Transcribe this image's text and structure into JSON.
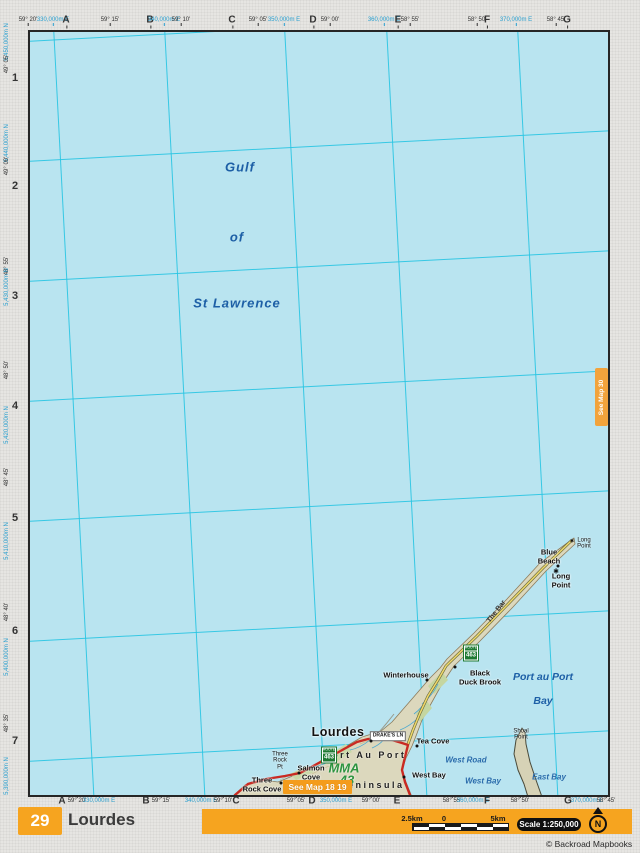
{
  "page": {
    "number": "29",
    "title": "Lourdes",
    "scale_label": "Scale 1:250,000",
    "copyright": "© Backroad Mapbooks",
    "north_label": "N",
    "see_map_right": "See Map 30",
    "see_map_bottom": "See Map 18 19",
    "scale_bar": {
      "left": "2.5km",
      "zero": "0",
      "right": "5km"
    }
  },
  "colors": {
    "accent_orange": "#f6a41f",
    "water": "#b9e4f0",
    "grid_cyan": "#28c4e2",
    "land": "#dcd8bd",
    "road_red": "#c92a22",
    "road_yellow": "#efd96b",
    "shield_green": "#1f7a33",
    "water_label_blue": "#1d5fa6",
    "utm_label_blue": "#2aa0d0",
    "mma_green": "#2e9440"
  },
  "margins": {
    "top": [
      {
        "t": "59° 20'",
        "x": 28,
        "cls": "deg"
      },
      {
        "t": "330,000m E",
        "x": 53,
        "cls": "utm"
      },
      {
        "t": "A",
        "x": 66,
        "cls": "col"
      },
      {
        "t": "59° 15'",
        "x": 110,
        "cls": "deg"
      },
      {
        "t": "B",
        "x": 150,
        "cls": "col"
      },
      {
        "t": "340,000m E",
        "x": 164,
        "cls": "utm"
      },
      {
        "t": "59° 10'",
        "x": 181,
        "cls": "deg"
      },
      {
        "t": "C",
        "x": 232,
        "cls": "col"
      },
      {
        "t": "59° 05'",
        "x": 258,
        "cls": "deg"
      },
      {
        "t": "350,000m E",
        "x": 284,
        "cls": "utm"
      },
      {
        "t": "D",
        "x": 313,
        "cls": "col"
      },
      {
        "t": "59° 00'",
        "x": 330,
        "cls": "deg"
      },
      {
        "t": "360,000m E",
        "x": 384,
        "cls": "utm"
      },
      {
        "t": "E",
        "x": 398,
        "cls": "col"
      },
      {
        "t": "58° 55'",
        "x": 410,
        "cls": "deg"
      },
      {
        "t": "58° 50'",
        "x": 477,
        "cls": "deg"
      },
      {
        "t": "F",
        "x": 487,
        "cls": "col"
      },
      {
        "t": "370,000m E",
        "x": 516,
        "cls": "utm"
      },
      {
        "t": "58° 45'",
        "x": 556,
        "cls": "deg"
      },
      {
        "t": "G",
        "x": 567,
        "cls": "col"
      }
    ],
    "bottom": [
      {
        "t": "A",
        "x": 62,
        "cls": "col"
      },
      {
        "t": "59° 20'",
        "x": 77,
        "cls": "deg"
      },
      {
        "t": "330,000m E",
        "x": 99,
        "cls": "utm"
      },
      {
        "t": "B",
        "x": 146,
        "cls": "col"
      },
      {
        "t": "59° 15'",
        "x": 161,
        "cls": "deg"
      },
      {
        "t": "340,000m E",
        "x": 201,
        "cls": "utm"
      },
      {
        "t": "59° 10'",
        "x": 223,
        "cls": "deg"
      },
      {
        "t": "C",
        "x": 236,
        "cls": "col"
      },
      {
        "t": "59° 05'",
        "x": 296,
        "cls": "deg"
      },
      {
        "t": "D",
        "x": 312,
        "cls": "col"
      },
      {
        "t": "350,000m E",
        "x": 336,
        "cls": "utm"
      },
      {
        "t": "59° 00'",
        "x": 371,
        "cls": "deg"
      },
      {
        "t": "E",
        "x": 397,
        "cls": "col"
      },
      {
        "t": "58° 55'",
        "x": 452,
        "cls": "deg"
      },
      {
        "t": "360,000m E",
        "x": 473,
        "cls": "utm"
      },
      {
        "t": "F",
        "x": 487,
        "cls": "col"
      },
      {
        "t": "58° 50'",
        "x": 520,
        "cls": "deg"
      },
      {
        "t": "G",
        "x": 568,
        "cls": "col"
      },
      {
        "t": "370,000m E",
        "x": 587,
        "cls": "utm"
      },
      {
        "t": "58° 45'",
        "x": 606,
        "cls": "deg"
      }
    ],
    "left": [
      {
        "t": "5,450,000m N",
        "x": 7,
        "y": 42,
        "cls": "utm"
      },
      {
        "t": "49° 05'",
        "x": 7,
        "y": 64,
        "cls": "deg"
      },
      {
        "t": "1",
        "x": 15,
        "y": 78,
        "cls": "row"
      },
      {
        "t": "5,440,000m N",
        "x": 7,
        "y": 143,
        "cls": "utm"
      },
      {
        "t": "49° 00'",
        "x": 7,
        "y": 166,
        "cls": "deg"
      },
      {
        "t": "2",
        "x": 15,
        "y": 186,
        "cls": "row"
      },
      {
        "t": "48° 55'",
        "x": 7,
        "y": 266,
        "cls": "deg"
      },
      {
        "t": "5,430,000m N",
        "x": 7,
        "y": 287,
        "cls": "utm"
      },
      {
        "t": "3",
        "x": 15,
        "y": 296,
        "cls": "row"
      },
      {
        "t": "48° 50'",
        "x": 7,
        "y": 370,
        "cls": "deg"
      },
      {
        "t": "4",
        "x": 15,
        "y": 406,
        "cls": "row"
      },
      {
        "t": "5,420,000m N",
        "x": 7,
        "y": 425,
        "cls": "utm"
      },
      {
        "t": "48° 45'",
        "x": 7,
        "y": 477,
        "cls": "deg"
      },
      {
        "t": "5",
        "x": 15,
        "y": 518,
        "cls": "row"
      },
      {
        "t": "5,410,000m N",
        "x": 7,
        "y": 541,
        "cls": "utm"
      },
      {
        "t": "48° 40'",
        "x": 7,
        "y": 612,
        "cls": "deg"
      },
      {
        "t": "6",
        "x": 15,
        "y": 631,
        "cls": "row"
      },
      {
        "t": "5,400,000m N",
        "x": 7,
        "y": 657,
        "cls": "utm"
      },
      {
        "t": "48° 35'",
        "x": 7,
        "y": 723,
        "cls": "deg"
      },
      {
        "t": "7",
        "x": 15,
        "y": 741,
        "cls": "row"
      },
      {
        "t": "5,390,000m N",
        "x": 7,
        "y": 776,
        "cls": "utm"
      }
    ]
  },
  "map": {
    "labels": [
      {
        "t": "Gulf",
        "x": 210,
        "y": 136,
        "cls": "water-big"
      },
      {
        "t": "of",
        "x": 207,
        "y": 206,
        "cls": "water-big"
      },
      {
        "t": "St Lawrence",
        "x": 207,
        "y": 272,
        "cls": "water-big"
      },
      {
        "t": "Port au Port",
        "x": 513,
        "y": 645,
        "cls": "water-mid"
      },
      {
        "t": "Bay",
        "x": 513,
        "y": 669,
        "cls": "water-mid"
      },
      {
        "t": "The Bar",
        "x": 467,
        "y": 580,
        "cls": "road-name",
        "rot": -52
      },
      {
        "t": "Blue\nBeach",
        "x": 519,
        "y": 525,
        "cls": "town"
      },
      {
        "t": "Long\nPoint",
        "x": 531,
        "y": 549,
        "cls": "town"
      },
      {
        "t": "Long\nPoint",
        "x": 554,
        "y": 512,
        "cls": "tiny"
      },
      {
        "t": "Winterhouse",
        "x": 376,
        "y": 644,
        "cls": "town"
      },
      {
        "t": "Black\nDuck Brook",
        "x": 450,
        "y": 646,
        "cls": "town"
      },
      {
        "t": "Lourdes",
        "x": 308,
        "y": 700,
        "cls": "town-big"
      },
      {
        "t": "DRAKE'S LN",
        "x": 358,
        "y": 704,
        "cls": "street-box"
      },
      {
        "t": "Tea Cove",
        "x": 403,
        "y": 710,
        "cls": "town"
      },
      {
        "t": "Port Au Port",
        "x": 335,
        "y": 723,
        "cls": "area"
      },
      {
        "t": "MMA",
        "x": 314,
        "y": 737,
        "cls": "mma"
      },
      {
        "t": "43",
        "x": 317,
        "y": 749,
        "cls": "mma"
      },
      {
        "t": "Peninsula",
        "x": 342,
        "y": 753,
        "cls": "area"
      },
      {
        "t": "Salmon\nCove",
        "x": 281,
        "y": 741,
        "cls": "town"
      },
      {
        "t": "Three\nRock Cove",
        "x": 232,
        "y": 753,
        "cls": "town"
      },
      {
        "t": "Three\nRock\nPt",
        "x": 250,
        "y": 729,
        "cls": "tiny"
      },
      {
        "t": "West Road",
        "x": 436,
        "y": 728,
        "cls": "water-small"
      },
      {
        "t": "West Bay",
        "x": 399,
        "y": 744,
        "cls": "town"
      },
      {
        "t": "West Bay",
        "x": 453,
        "y": 749,
        "cls": "water-small"
      },
      {
        "t": "East Bay",
        "x": 519,
        "y": 745,
        "cls": "water-small"
      },
      {
        "t": "Shoal\nPoint",
        "x": 491,
        "y": 703,
        "cls": "tiny"
      }
    ],
    "markers": [
      {
        "x": 341,
        "y": 709,
        "cls": "dot"
      },
      {
        "x": 387,
        "y": 714,
        "cls": "dot"
      },
      {
        "x": 374,
        "y": 745,
        "cls": "dot"
      },
      {
        "x": 269,
        "y": 741,
        "cls": "dot"
      },
      {
        "x": 251,
        "y": 751,
        "cls": "dot"
      },
      {
        "x": 425,
        "y": 635,
        "cls": "dot"
      },
      {
        "x": 397,
        "y": 648,
        "cls": "dot"
      },
      {
        "x": 528,
        "y": 534,
        "cls": "dot"
      },
      {
        "x": 526,
        "y": 540,
        "cls": "star",
        "t": "✱"
      },
      {
        "x": 542,
        "y": 510,
        "cls": "star-sm",
        "t": "✱"
      }
    ],
    "shields": [
      {
        "top": "ROUTE",
        "num": "463",
        "x": 441,
        "y": 621
      },
      {
        "top": "ROUTE",
        "num": "463",
        "x": 299,
        "y": 723
      }
    ]
  }
}
